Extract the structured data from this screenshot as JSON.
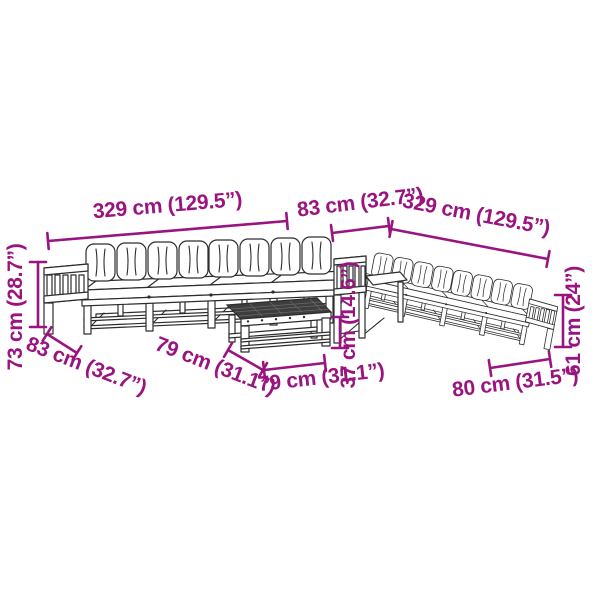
{
  "diagram": {
    "kind": "furniture-dimension-diagram",
    "subject": "garden-lounge-set-with-coffee-table",
    "accent_color": "#9A1480",
    "line_color": "#2D2D2D",
    "background_color": "#FFFFFF"
  },
  "dims": {
    "left_sofa_width": "329 cm (129.5”)",
    "corner_width": "83 cm (32.7”)",
    "right_sofa_width": "329 cm (129.5”)",
    "left_sofa_height": "73 cm (28.7”)",
    "left_sofa_depth": "83 cm (32.7”)",
    "table_depth": "79 cm (31.1”)",
    "table_width": "79 cm (31.1”)",
    "table_height": "37 cm (14.6”)",
    "right_sofa_height": "61 cm (24”)",
    "right_sofa_depth": "80 cm (31.5”)"
  }
}
